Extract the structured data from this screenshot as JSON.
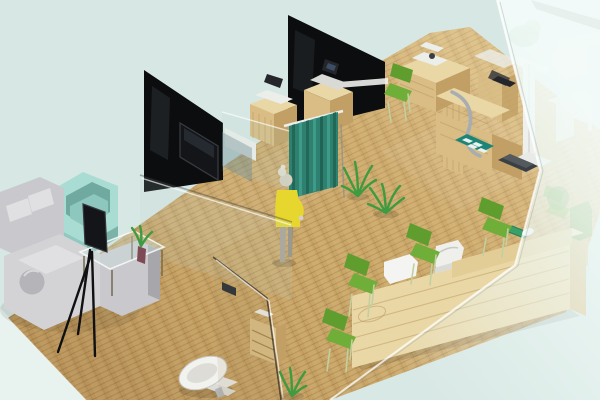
{
  "scene": {
    "type": "isometric-3d-interior-render",
    "description": "Isometric 3D rendering of a small clinic interior: waiting lounge with sofas, black partition walls with TV, teal privacy curtain with a standing person in a yellow dress, examination station with height scale, long wooden reception counter with green chairs, washroom with toilet, all behind a frosted glass facade",
    "areas": [
      {
        "name": "waiting-lounge",
        "items": [
          "gray sectional sofa",
          "teal armchair",
          "glass coffee table",
          "potted plant",
          "display on tripod stand"
        ]
      },
      {
        "name": "consultation-corridor",
        "items": [
          "black partition walls",
          "wall-mounted tv",
          "printer cabinets",
          "teal privacy curtain",
          "person in yellow dress",
          "floor plants"
        ]
      },
      {
        "name": "exam-station",
        "items": [
          "wooden exam desk",
          "white instrument",
          "chrome tube",
          "teal floor mat",
          "height scale with dark platform",
          "green chair"
        ]
      },
      {
        "name": "reception",
        "items": [
          "long wooden counter",
          "two white chairs",
          "four green visitor chairs",
          "green tray with mouse"
        ]
      },
      {
        "name": "washroom",
        "items": [
          "toilet",
          "glass partition",
          "wooden shelf",
          "plant"
        ]
      },
      {
        "name": "glass-facade",
        "items": [
          "frosted glass wall overlay",
          "ghosted equipment behind glass"
        ]
      }
    ]
  },
  "colors": {
    "background": "#d7e7e3",
    "background_corner": "#e8f3f0",
    "floor_wood": "#c9a76a",
    "wall_black": "#0c0d0f",
    "curtain_teal": "#2e8170",
    "wood_light": "#ead7a6",
    "wood_mid": "#d9bd85",
    "wood_dark": "#c2a065",
    "chair_green": "#6fae38",
    "chair_green_dark": "#5f9e2e",
    "sofa_gray": "#c9c9cd",
    "sofa_gray_light": "#e0e0e2",
    "armchair_teal": "#a9ddd4",
    "device_white": "#eceeea",
    "screen_dark": "#24262b",
    "person_dress": "#e6d62e",
    "person_skin": "#d6d0c0",
    "plant_green": "#3f9b3f",
    "toilet_white": "#f2f2ef",
    "metal_chrome": "#a7adb0",
    "platform_dark": "#3a3f44",
    "tray_green": "#3aa06a"
  }
}
